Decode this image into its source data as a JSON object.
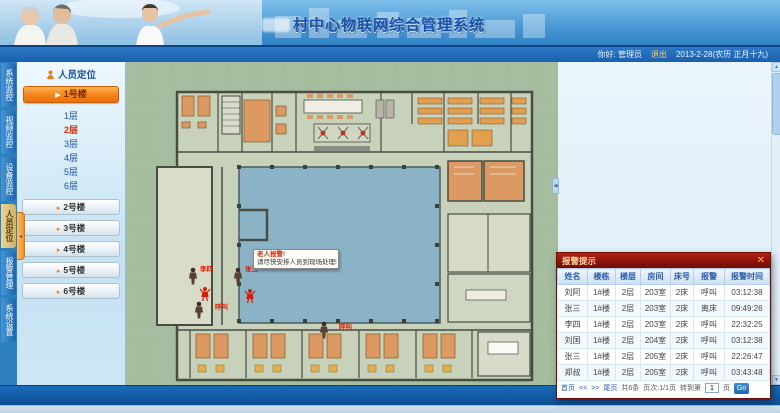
{
  "header": {
    "title": "村中心物联网综合管理系统",
    "greeting": "你好: 管理员",
    "logout": "退出",
    "date": "2013-2-28(农历 正月十九)"
  },
  "nav_tabs": [
    {
      "label": "系统监控",
      "active": false
    },
    {
      "label": "视频监控",
      "active": false
    },
    {
      "label": "设备监控",
      "active": false
    },
    {
      "label": "人员定位",
      "active": true
    },
    {
      "label": "报警管理",
      "active": false
    },
    {
      "label": "系统设置",
      "active": false
    }
  ],
  "sidebar": {
    "panel_title": "人员定位",
    "active_building": "1号楼",
    "floors": [
      {
        "label": "1层",
        "active": false
      },
      {
        "label": "2层",
        "active": true
      },
      {
        "label": "3层",
        "active": false
      },
      {
        "label": "4层",
        "active": false
      },
      {
        "label": "5层",
        "active": false
      },
      {
        "label": "6层",
        "active": false
      }
    ],
    "buildings": [
      "2号楼",
      "3号楼",
      "4号楼",
      "5号楼",
      "6号楼"
    ]
  },
  "floorplan": {
    "tooltip": {
      "line1": "老人报警!",
      "line2": "请尽快安排人员到现场处理!"
    },
    "markers": [
      {
        "type": "person",
        "x": 67,
        "y": 215,
        "label": "李四",
        "lx": 74,
        "ly": 209
      },
      {
        "type": "person",
        "x": 112,
        "y": 215,
        "label": "张三",
        "lx": 119,
        "ly": 209
      },
      {
        "type": "alarm",
        "x": 79,
        "y": 233,
        "label": "",
        "lx": 0,
        "ly": 0
      },
      {
        "type": "alarm",
        "x": 124,
        "y": 235,
        "label": "",
        "lx": 0,
        "ly": 0
      },
      {
        "type": "person",
        "x": 73,
        "y": 249,
        "label": "呼叫",
        "lx": 89,
        "ly": 247
      },
      {
        "type": "person",
        "x": 198,
        "y": 269,
        "label": "呼叫",
        "lx": 213,
        "ly": 267
      }
    ]
  },
  "alarm_popup": {
    "title": "报警提示",
    "close": "✕",
    "columns": [
      "姓名",
      "楼栋",
      "楼层",
      "房间",
      "床号",
      "报警",
      "报警时间"
    ],
    "rows": [
      [
        "刘阿",
        "1#楼",
        "2层",
        "203室",
        "2床",
        "呼叫",
        "03:12:38"
      ],
      [
        "张三",
        "1#楼",
        "2层",
        "203室",
        "2床",
        "离床",
        "09:49:26"
      ],
      [
        "李四",
        "1#楼",
        "2层",
        "203室",
        "2床",
        "呼叫",
        "22:32:25"
      ],
      [
        "刘国",
        "1#楼",
        "2层",
        "204室",
        "2床",
        "呼叫",
        "03:12:38"
      ],
      [
        "张三",
        "1#楼",
        "2层",
        "205室",
        "2床",
        "呼叫",
        "22:26:47"
      ],
      [
        "郑叔",
        "1#楼",
        "2层",
        "205室",
        "2床",
        "呼叫",
        "03:43:48"
      ]
    ],
    "pagination": {
      "first": "首页",
      "prev": "<<",
      "next": ">>",
      "last": "尾页",
      "count": "共6条",
      "page": "页次:1/1页",
      "goto_label": "转到第",
      "page_value": "1",
      "unit": "页",
      "go": "Go"
    }
  },
  "footer": {
    "calls": "4856次",
    "right_text": "下载 0 张图片"
  },
  "colors": {
    "accent_orange": "#f58a20",
    "alarm_red": "#8c130a",
    "header_blue": "#2f82c6",
    "plan_green": "#a6bc9e",
    "courtyard_blue": "#8bb3c6"
  }
}
